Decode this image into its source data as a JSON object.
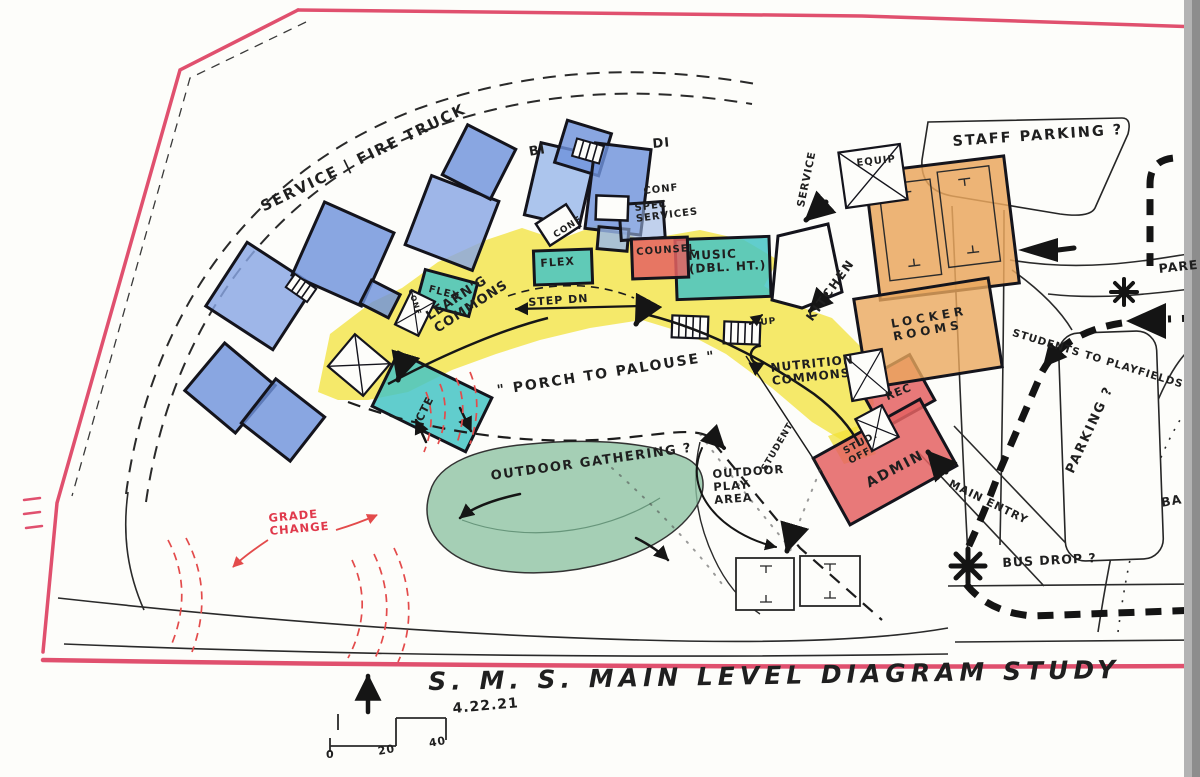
{
  "title_block": {
    "title": "S. M. S.   MAIN  LEVEL  DIAGRAM  STUDY",
    "date": "4.22.21",
    "scale_ticks": {
      "t0": "0",
      "t1": "20",
      "t2": "40"
    }
  },
  "site_labels": {
    "service_fire_truck": "SERVICE | FIRE TRUCK",
    "staff_parking": "STAFF PARKING ?",
    "parent_partial": "PARE",
    "students_to_playfields": "STUDENTS TO PLAYFIELDS",
    "parking": "PARKING ?",
    "ballfields_partial": "BA",
    "bus_drop": "BUS DROP ?",
    "main_entry": "MAIN ENTRY",
    "service": "SERVICE",
    "student": "STUDENT",
    "grade_change": "GRADE\nCHANGE",
    "porch_to_palouse": "\" PORCH TO PALOUSE \"",
    "outdoor_gathering": "OUTDOOR GATHERING ?",
    "outdoor_play": "OUTDOOR\n PLAY\n  AREA"
  },
  "rooms": {
    "bi": "BI",
    "di": "DI",
    "conf_north": "CONF",
    "conf_mid": "CONF",
    "conf_small": "CONF",
    "spec_services": "SPEC\nSERVICES",
    "counsel": "COUNSEL",
    "music": "MUSIC\n(DBL. HT.)",
    "flex_east": "FLEX",
    "flex_west": "FLEX",
    "learning_commons": "LEARN'G\nCOMMONS",
    "step_dn": "STEP DN",
    "up": "UP",
    "cte": "CTE",
    "kitchen": "KITCHEN",
    "nutrition_commons": "NUTRITION\nCOMMONS",
    "locker_rooms": "LOCKER\nROOMS",
    "rec": "REC",
    "stud_off": "STUD.\nOFF.",
    "admin": "ADMIN",
    "equip": "EQUIP"
  },
  "colors": {
    "boundary_pink": "#e0506e",
    "classroom_blue": "#6f92dc",
    "commons_yellow": "#f2e23a",
    "flex_teal": "#45c4c4",
    "admin_red": "#e46262",
    "gym_orange": "#eaa75e",
    "landscape_green": "#8cc2a2",
    "annotation_red": "#e34b4b",
    "ink_black": "#1c1c1c"
  }
}
